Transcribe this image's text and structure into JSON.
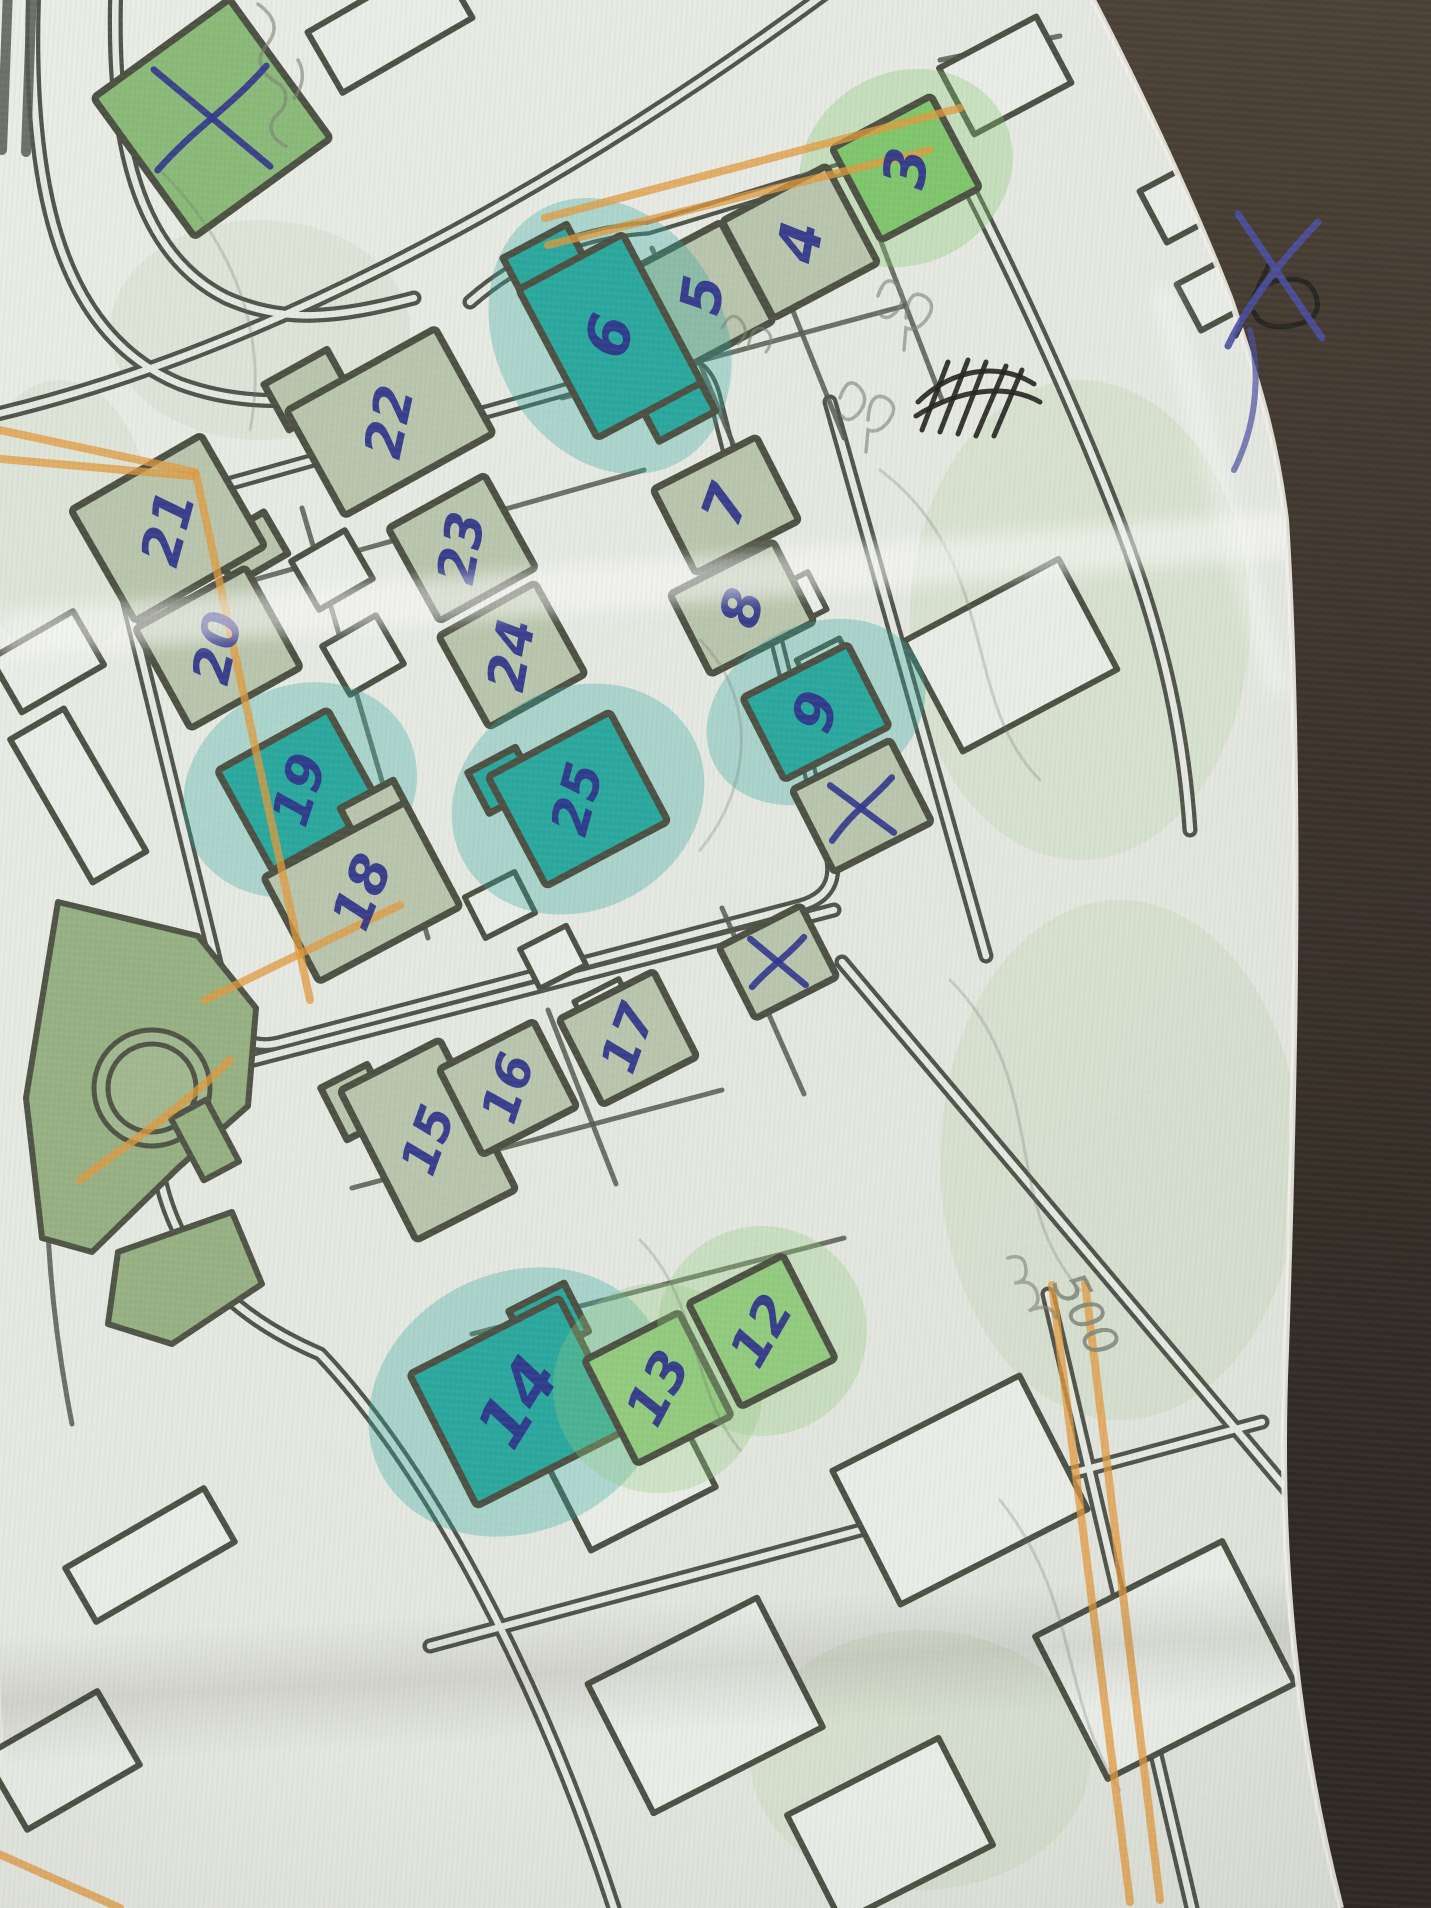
{
  "meta": {
    "description": "Photograph of a hand-annotated paper street map with numbered buildings",
    "surface": "dark brown table under the paper's right edge"
  },
  "colors": {
    "paper": "#e6e9e2",
    "road": "#50544a",
    "outline": "#4c5143",
    "sage": "#b9c5ac",
    "bright": "#7fc66c",
    "bright2": "#92cb7e",
    "teal": "#2aa89e",
    "greenmid": "#8aba78",
    "ink_blue": "#2f338a",
    "pencil": "#7d8278",
    "orange_pencil": "#e09a3e",
    "table": "#3e352c"
  },
  "annotations": {
    "distance_label": "500",
    "cross_mark_meaning": "hand-drawn blue X over crossed-off buildings",
    "scribble": "black ink crossed-out scribble near paper edge"
  },
  "buildings": [
    {
      "label": "",
      "cx": 212,
      "cy": 118,
      "w": 168,
      "h": 172,
      "rot": -36,
      "fill": "greenmid",
      "cross": true
    },
    {
      "label": "3",
      "cx": 906,
      "cy": 168,
      "w": 112,
      "h": 104,
      "rot": -28,
      "fill": "bright",
      "halo": true,
      "label_rot": -82,
      "label_size": 58
    },
    {
      "label": "4",
      "cx": 800,
      "cy": 242,
      "w": 118,
      "h": 110,
      "rot": -28,
      "fill": "sage",
      "label_rot": -80,
      "label_size": 58
    },
    {
      "label": "5",
      "cx": 703,
      "cy": 295,
      "w": 100,
      "h": 112,
      "rot": -28,
      "fill": "sage",
      "label_rot": -82,
      "label_size": 56
    },
    {
      "label": "6",
      "cx": 610,
      "cy": 336,
      "w": 118,
      "h": 168,
      "rot": -28,
      "fill": "teal",
      "halo": true,
      "label_rot": -75,
      "label_size": 60,
      "wings": [
        {
          "dx": -22,
          "dy": -98,
          "w": 72,
          "h": 42
        },
        {
          "dx": 26,
          "dy": 96,
          "w": 64,
          "h": 40
        }
      ]
    },
    {
      "label": "7",
      "cx": 726,
      "cy": 505,
      "w": 116,
      "h": 94,
      "rot": -27,
      "fill": "sage",
      "label_rot": -70,
      "label_size": 56
    },
    {
      "label": "8",
      "cx": 742,
      "cy": 608,
      "w": 116,
      "h": 90,
      "rot": -27,
      "fill": "sage",
      "label_rot": -75,
      "label_size": 54
    },
    {
      "label": "9",
      "cx": 816,
      "cy": 712,
      "w": 118,
      "h": 92,
      "rot": -27,
      "fill": "teal",
      "halo": true,
      "label_rot": -72,
      "label_size": 56
    },
    {
      "label": "",
      "cx": 862,
      "cy": 806,
      "w": 110,
      "h": 92,
      "rot": -27,
      "fill": "sage",
      "cross": true
    },
    {
      "label": "",
      "cx": 778,
      "cy": 962,
      "w": 92,
      "h": 80,
      "rot": -27,
      "fill": "sage",
      "cross": true
    },
    {
      "label": "22",
      "cx": 390,
      "cy": 422,
      "w": 170,
      "h": 120,
      "rot": -29,
      "fill": "sage",
      "label_rot": -78,
      "label_size": 52,
      "wings": [
        {
          "dx": -56,
          "dy": -68,
          "w": 72,
          "h": 52
        }
      ]
    },
    {
      "label": "21",
      "cx": 168,
      "cy": 528,
      "w": 150,
      "h": 128,
      "rot": -30,
      "fill": "sage",
      "label_rot": -75,
      "label_size": 54,
      "wings": [
        {
          "dx": 60,
          "dy": 58,
          "w": 62,
          "h": 48
        }
      ]
    },
    {
      "label": "23",
      "cx": 462,
      "cy": 548,
      "w": 110,
      "h": 106,
      "rot": -29,
      "fill": "sage",
      "label_rot": -80,
      "label_size": 52
    },
    {
      "label": "20",
      "cx": 218,
      "cy": 648,
      "w": 126,
      "h": 114,
      "rot": -29,
      "fill": "sage",
      "label_rot": -78,
      "label_size": 52
    },
    {
      "label": "24",
      "cx": 512,
      "cy": 655,
      "w": 110,
      "h": 104,
      "rot": -29,
      "fill": "sage",
      "label_rot": -80,
      "label_size": 52
    },
    {
      "label": "19",
      "cx": 300,
      "cy": 790,
      "w": 126,
      "h": 114,
      "rot": -29,
      "fill": "teal",
      "halo": true,
      "label_rot": -72,
      "label_size": 52
    },
    {
      "label": "25",
      "cx": 578,
      "cy": 799,
      "w": 138,
      "h": 124,
      "rot": -28,
      "fill": "teal",
      "halo": true,
      "label_rot": -75,
      "label_size": 52,
      "wings": [
        {
          "dx": -58,
          "dy": -52,
          "w": 54,
          "h": 46
        }
      ]
    },
    {
      "label": "18",
      "cx": 362,
      "cy": 892,
      "w": 160,
      "h": 118,
      "rot": -28,
      "fill": "sage",
      "label_rot": -68,
      "label_size": 54,
      "wings": [
        {
          "dx": 50,
          "dy": -62,
          "w": 60,
          "h": 44
        }
      ]
    },
    {
      "label": "15",
      "cx": 428,
      "cy": 1140,
      "w": 112,
      "h": 168,
      "rot": -27,
      "fill": "sage",
      "label_rot": -70,
      "label_size": 50,
      "wings": [
        {
          "dx": -46,
          "dy": -66,
          "w": 52,
          "h": 58
        }
      ]
    },
    {
      "label": "16",
      "cx": 508,
      "cy": 1088,
      "w": 106,
      "h": 96,
      "rot": -27,
      "fill": "sage",
      "label_rot": -72,
      "label_size": 50
    },
    {
      "label": "17",
      "cx": 628,
      "cy": 1038,
      "w": 106,
      "h": 96,
      "rot": -27,
      "fill": "sage",
      "label_rot": -70,
      "label_size": 50
    },
    {
      "label": "14",
      "cx": 518,
      "cy": 1402,
      "w": 168,
      "h": 148,
      "rot": -27,
      "fill": "teal",
      "halo": true,
      "label_rot": -58,
      "label_size": 66,
      "wings": [
        {
          "dx": 64,
          "dy": -58,
          "w": 62,
          "h": 54
        }
      ]
    },
    {
      "label": "13",
      "cx": 658,
      "cy": 1388,
      "w": 106,
      "h": 116,
      "rot": -27,
      "fill": "bright2",
      "halo": true,
      "label_rot": -62,
      "label_size": 54
    },
    {
      "label": "12",
      "cx": 762,
      "cy": 1331,
      "w": 106,
      "h": 116,
      "rot": -27,
      "fill": "bright2",
      "halo": true,
      "label_rot": -60,
      "label_size": 52
    }
  ]
}
